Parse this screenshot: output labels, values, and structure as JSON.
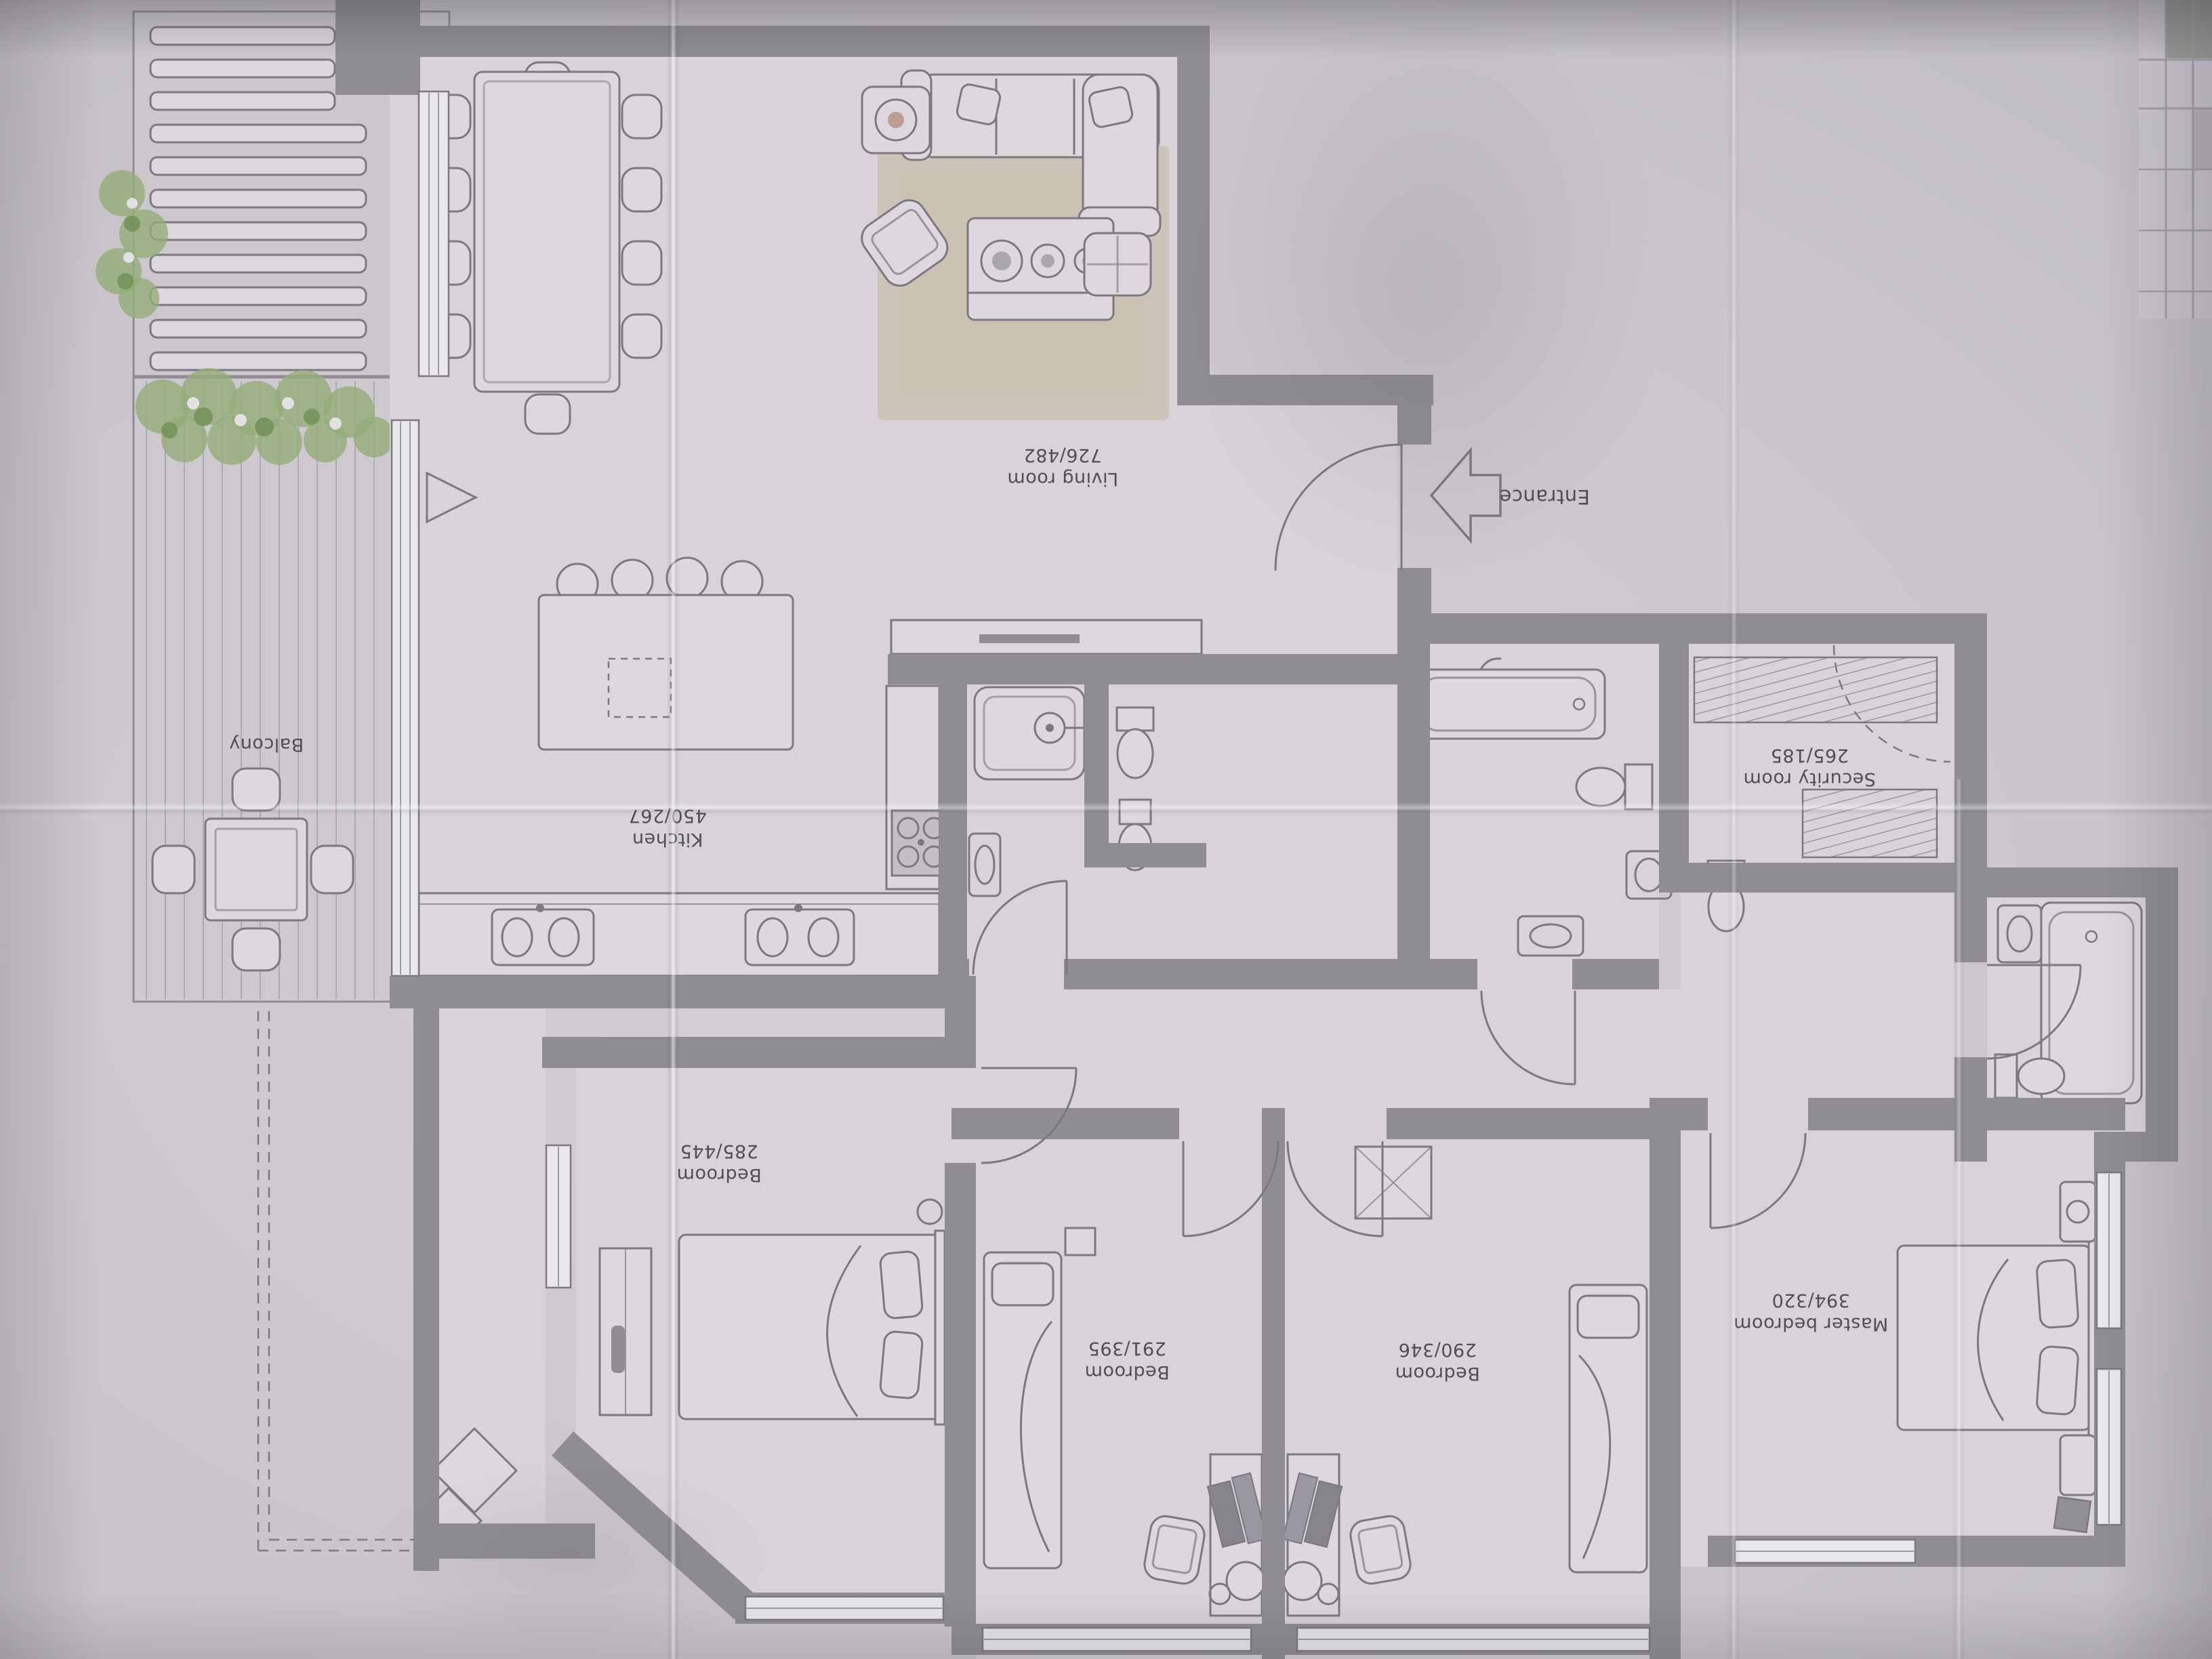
{
  "colors": {
    "paper": "#c8c4ca",
    "paper_light": "#d5d1d6",
    "paper_dark": "#b1adb4",
    "room": "#d7d3d9",
    "furn": "#dcd8dd",
    "wall": "#8f8c93",
    "line": "#7b7880",
    "text": "#504d56",
    "window": "#e9e7ec",
    "rug": "#c9bfae",
    "plant": "#94ad78",
    "plant_dark": "#6f8f55",
    "deck": "#adaab1"
  },
  "rooms": {
    "living": {
      "name": "Living room",
      "size": "726/482"
    },
    "kitchen": {
      "name": "Kitchen",
      "size": "450/267"
    },
    "security": {
      "name": "Security room",
      "size": "265/185"
    },
    "bedroom1": {
      "name": "Bedroom",
      "size": "285/445"
    },
    "bedroom2": {
      "name": "Bedroom",
      "size": "291/395"
    },
    "bedroom3": {
      "name": "Bedroom",
      "size": "290/346"
    },
    "master": {
      "name": "Master bedroom",
      "size": "394/320"
    },
    "balcony": {
      "name": "Balcony"
    }
  },
  "entrance": {
    "label": "Entrance"
  }
}
